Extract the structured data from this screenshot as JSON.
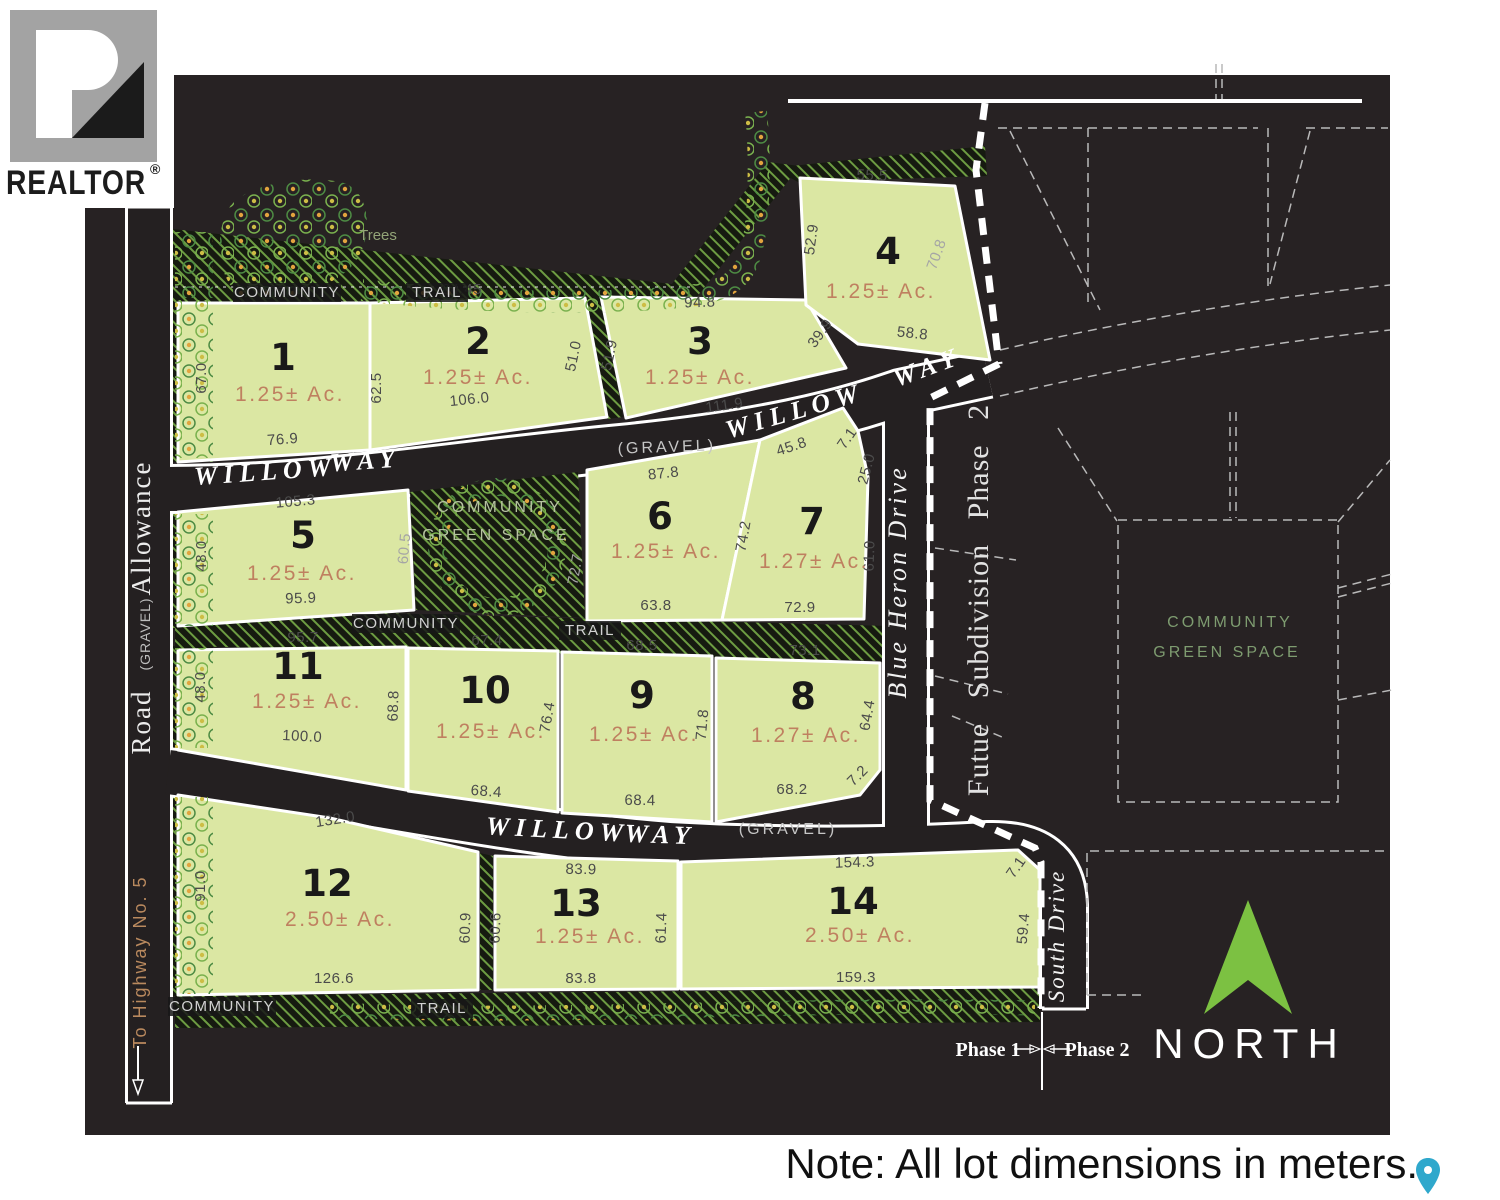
{
  "note": {
    "text": "Note: All lot dimensions in meters."
  },
  "logo": {
    "text": "REALTOR",
    "registered": "®"
  },
  "compass": {
    "label": "NORTH",
    "color": "#7cc142"
  },
  "colors": {
    "map_background": "#272223",
    "lot_fill": "#dbe7a3",
    "lot_stroke": "#ffffff",
    "area_text": "#bf8060",
    "dimension_text": "#4b4b4b",
    "north_green": "#7cc142",
    "trail_hatch_green": "#6d9c42",
    "pin_teal": "#2fa8cc"
  },
  "lots": [
    {
      "num": "1",
      "area": "1.25± Ac.",
      "num_xy": [
        283,
        370
      ],
      "area_xy": [
        290,
        401
      ]
    },
    {
      "num": "2",
      "area": "1.25± Ac.",
      "num_xy": [
        478,
        354
      ],
      "area_xy": [
        478,
        384
      ]
    },
    {
      "num": "3",
      "area": "1.25± Ac.",
      "num_xy": [
        700,
        354
      ],
      "area_xy": [
        700,
        384
      ]
    },
    {
      "num": "4",
      "area": "1.25± Ac.",
      "num_xy": [
        888,
        264
      ],
      "area_xy": [
        881,
        298
      ]
    },
    {
      "num": "5",
      "area": "1.25± Ac.",
      "num_xy": [
        303,
        548
      ],
      "area_xy": [
        302,
        580
      ]
    },
    {
      "num": "6",
      "area": "1.25± Ac.",
      "num_xy": [
        660,
        529
      ],
      "area_xy": [
        666,
        558
      ]
    },
    {
      "num": "7",
      "area": "1.27± Ac.",
      "num_xy": [
        812,
        534
      ],
      "area_xy": [
        814,
        568
      ]
    },
    {
      "num": "8",
      "area": "1.27± Ac.",
      "num_xy": [
        803,
        709
      ],
      "area_xy": [
        806,
        742
      ]
    },
    {
      "num": "9",
      "area": "1.25± Ac.",
      "num_xy": [
        642,
        708
      ],
      "area_xy": [
        644,
        741
      ]
    },
    {
      "num": "10",
      "area": "1.25± Ac.",
      "num_xy": [
        485,
        703
      ],
      "area_xy": [
        491,
        738
      ]
    },
    {
      "num": "11",
      "area": "1.25± Ac.",
      "num_xy": [
        298,
        679
      ],
      "area_xy": [
        307,
        708
      ]
    },
    {
      "num": "12",
      "area": "2.50± Ac.",
      "num_xy": [
        327,
        896
      ],
      "area_xy": [
        340,
        926
      ]
    },
    {
      "num": "13",
      "area": "1.25± Ac.",
      "num_xy": [
        576,
        916
      ],
      "area_xy": [
        590,
        943
      ]
    },
    {
      "num": "14",
      "area": "2.50± Ac.",
      "num_xy": [
        853,
        914
      ],
      "area_xy": [
        860,
        942
      ]
    }
  ],
  "dimensions": [
    {
      "t": "76.1",
      "x": 283,
      "y": 296,
      "r": 0
    },
    {
      "t": "67.0",
      "x": 206,
      "y": 378,
      "r": -90
    },
    {
      "t": "76.9",
      "x": 283,
      "y": 444,
      "r": -4
    },
    {
      "t": "62.5",
      "x": 381,
      "y": 388,
      "r": -90
    },
    {
      "t": "94.45",
      "x": 462,
      "y": 294,
      "r": 0
    },
    {
      "t": "106.0",
      "x": 470,
      "y": 404,
      "r": -6
    },
    {
      "t": "51.0",
      "x": 578,
      "y": 357,
      "r": -78
    },
    {
      "t": "51.9",
      "x": 614,
      "y": 356,
      "r": -78
    },
    {
      "t": "94.8",
      "x": 700,
      "y": 307,
      "r": -2
    },
    {
      "t": "39.9",
      "x": 824,
      "y": 336,
      "r": -55
    },
    {
      "t": "111.9",
      "x": 725,
      "y": 410,
      "r": -8
    },
    {
      "t": "55.5",
      "x": 872,
      "y": 180,
      "r": 2
    },
    {
      "t": "52.9",
      "x": 816,
      "y": 240,
      "r": -82
    },
    {
      "t": "70.8",
      "x": 941,
      "y": 256,
      "r": -70,
      "light": true
    },
    {
      "t": "58.8",
      "x": 912,
      "y": 338,
      "r": 6
    },
    {
      "t": "105.3",
      "x": 296,
      "y": 506,
      "r": -5
    },
    {
      "t": "48.0",
      "x": 206,
      "y": 556,
      "r": -90
    },
    {
      "t": "60.5",
      "x": 409,
      "y": 549,
      "r": -85,
      "light": true
    },
    {
      "t": "95.9",
      "x": 301,
      "y": 603,
      "r": -2
    },
    {
      "t": "72.7",
      "x": 580,
      "y": 570,
      "r": -80,
      "light": true
    },
    {
      "t": "87.8",
      "x": 664,
      "y": 478,
      "r": -6
    },
    {
      "t": "74.2",
      "x": 748,
      "y": 537,
      "r": -80
    },
    {
      "t": "63.8",
      "x": 656,
      "y": 610,
      "r": 0
    },
    {
      "t": "45.8",
      "x": 793,
      "y": 451,
      "r": -18
    },
    {
      "t": "7.1",
      "x": 851,
      "y": 441,
      "r": -55
    },
    {
      "t": "25.0",
      "x": 871,
      "y": 470,
      "r": -75
    },
    {
      "t": "61.0",
      "x": 874,
      "y": 556,
      "r": -88
    },
    {
      "t": "72.9",
      "x": 800,
      "y": 612,
      "r": 0
    },
    {
      "t": "95.7",
      "x": 303,
      "y": 642,
      "r": 0
    },
    {
      "t": "48.0",
      "x": 205,
      "y": 687,
      "r": -90
    },
    {
      "t": "68.8",
      "x": 398,
      "y": 706,
      "r": -88
    },
    {
      "t": "100.0",
      "x": 302,
      "y": 741,
      "r": 3
    },
    {
      "t": "67.4",
      "x": 487,
      "y": 645,
      "r": 0
    },
    {
      "t": "76.4",
      "x": 552,
      "y": 718,
      "r": -80
    },
    {
      "t": "68.4",
      "x": 486,
      "y": 796,
      "r": 4
    },
    {
      "t": "68.5",
      "x": 642,
      "y": 650,
      "r": 0
    },
    {
      "t": "71.8",
      "x": 707,
      "y": 725,
      "r": -85
    },
    {
      "t": "68.4",
      "x": 640,
      "y": 805,
      "r": 1
    },
    {
      "t": "73.1",
      "x": 805,
      "y": 655,
      "r": 0
    },
    {
      "t": "64.4",
      "x": 872,
      "y": 716,
      "r": -80
    },
    {
      "t": "7.2",
      "x": 861,
      "y": 779,
      "r": -45
    },
    {
      "t": "68.2",
      "x": 792,
      "y": 794,
      "r": 0
    },
    {
      "t": "132.0",
      "x": 336,
      "y": 824,
      "r": -9
    },
    {
      "t": "91.0",
      "x": 205,
      "y": 886,
      "r": -90
    },
    {
      "t": "60.9",
      "x": 470,
      "y": 928,
      "r": -88
    },
    {
      "t": "126.6",
      "x": 334,
      "y": 983,
      "r": 0
    },
    {
      "t": "60.6",
      "x": 500,
      "y": 928,
      "r": -88
    },
    {
      "t": "83.9",
      "x": 581,
      "y": 874,
      "r": 1
    },
    {
      "t": "61.4",
      "x": 666,
      "y": 928,
      "r": -88
    },
    {
      "t": "83.8",
      "x": 581,
      "y": 983,
      "r": 0
    },
    {
      "t": "154.3",
      "x": 855,
      "y": 867,
      "r": -2
    },
    {
      "t": "7.1",
      "x": 1020,
      "y": 870,
      "r": -55
    },
    {
      "t": "59.4",
      "x": 1028,
      "y": 929,
      "r": -85
    },
    {
      "t": "159.3",
      "x": 856,
      "y": 982,
      "r": 0
    }
  ],
  "road_labels": [
    {
      "t": "WILLOW",
      "x": 266,
      "y": 480,
      "r": -4,
      "c": "rd"
    },
    {
      "t": "WAY",
      "x": 366,
      "y": 469,
      "r": -4,
      "c": "rd"
    },
    {
      "t": "(GRAVEL)",
      "x": 667,
      "y": 452,
      "r": -2,
      "c": "grv"
    },
    {
      "t": "WILLOW",
      "x": 797,
      "y": 419,
      "r": -16,
      "c": "rd"
    },
    {
      "t": "WAY",
      "x": 930,
      "y": 375,
      "r": -20,
      "c": "rd"
    },
    {
      "t": "WILLOW",
      "x": 557,
      "y": 838,
      "r": 3,
      "c": "rd"
    },
    {
      "t": "WAY",
      "x": 660,
      "y": 843,
      "r": 2,
      "c": "rd"
    },
    {
      "t": "(GRAVEL)",
      "x": 788,
      "y": 834,
      "r": 0,
      "c": "grv"
    },
    {
      "t": "Blue Heron Drive",
      "x": 906,
      "y": 582,
      "r": -90,
      "c": "rd2"
    },
    {
      "t": "South Drive",
      "x": 1064,
      "y": 936,
      "r": -90,
      "c": "rd2s"
    },
    {
      "t": "Allowance",
      "x": 150,
      "y": 528,
      "r": -90,
      "c": "srf"
    },
    {
      "t": "(GRAVEL)",
      "x": 150,
      "y": 634,
      "r": -90,
      "c": "grvs"
    },
    {
      "t": "Road",
      "x": 150,
      "y": 722,
      "r": -90,
      "c": "srf"
    },
    {
      "t": "To Highway No. 5",
      "x": 146,
      "y": 962,
      "r": -90,
      "c": "hwy"
    }
  ],
  "trail_labels": [
    {
      "t": "COMMUNITY",
      "x": 287,
      "y": 297,
      "w": 100
    },
    {
      "t": "TRAIL",
      "x": 437,
      "y": 297,
      "w": 54
    },
    {
      "t": "COMMUNITY",
      "x": 406,
      "y": 628,
      "w": 100
    },
    {
      "t": "TRAIL",
      "x": 590,
      "y": 635,
      "w": 54
    },
    {
      "t": "COMMUNITY",
      "x": 222,
      "y": 1011,
      "w": 100
    },
    {
      "t": "TRAIL",
      "x": 442,
      "y": 1013,
      "w": 54
    }
  ],
  "misc_labels": [
    {
      "t": "Trees",
      "x": 378,
      "y": 240,
      "r": 0,
      "c": "treestxt"
    },
    {
      "t": "COMMUNITY",
      "x": 500,
      "y": 512,
      "r": 0,
      "c": "gstxt"
    },
    {
      "t": "GREEN SPACE",
      "x": 496,
      "y": 540,
      "r": 0,
      "c": "gstxt"
    },
    {
      "t": "COMMUNITY",
      "x": 1230,
      "y": 627,
      "r": 0,
      "c": "gs2txt"
    },
    {
      "t": "GREEN SPACE",
      "x": 1227,
      "y": 657,
      "r": 0,
      "c": "gs2txt"
    },
    {
      "t": "Futue Subdivision Phase 2",
      "x": 988,
      "y": 600,
      "r": -90,
      "c": "futuretxt"
    },
    {
      "t": "Phase 1",
      "x": 988,
      "y": 1056,
      "r": 0,
      "c": "bl"
    },
    {
      "t": "Phase 2",
      "x": 1097,
      "y": 1056,
      "r": 0,
      "c": "bl"
    }
  ]
}
